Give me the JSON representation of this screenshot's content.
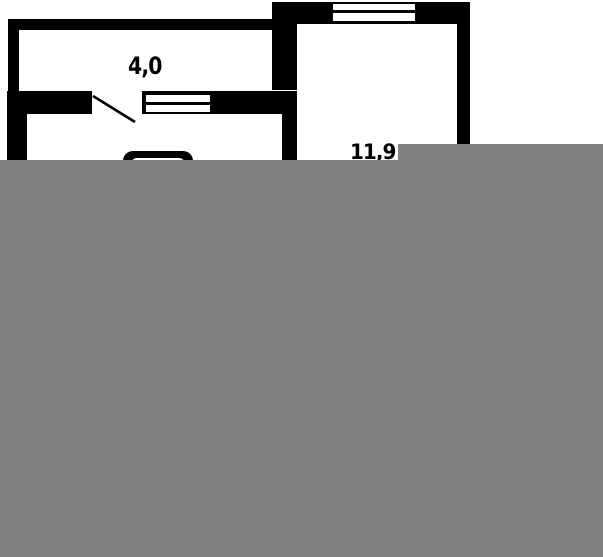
{
  "title": "Floor plan fragment",
  "colors": {
    "wall": "#000000",
    "background": "#ffffff",
    "overlay": "#808080",
    "text": "#000000"
  },
  "rooms": [
    {
      "area_label": "4,0"
    },
    {
      "area_label": "11,9"
    }
  ]
}
